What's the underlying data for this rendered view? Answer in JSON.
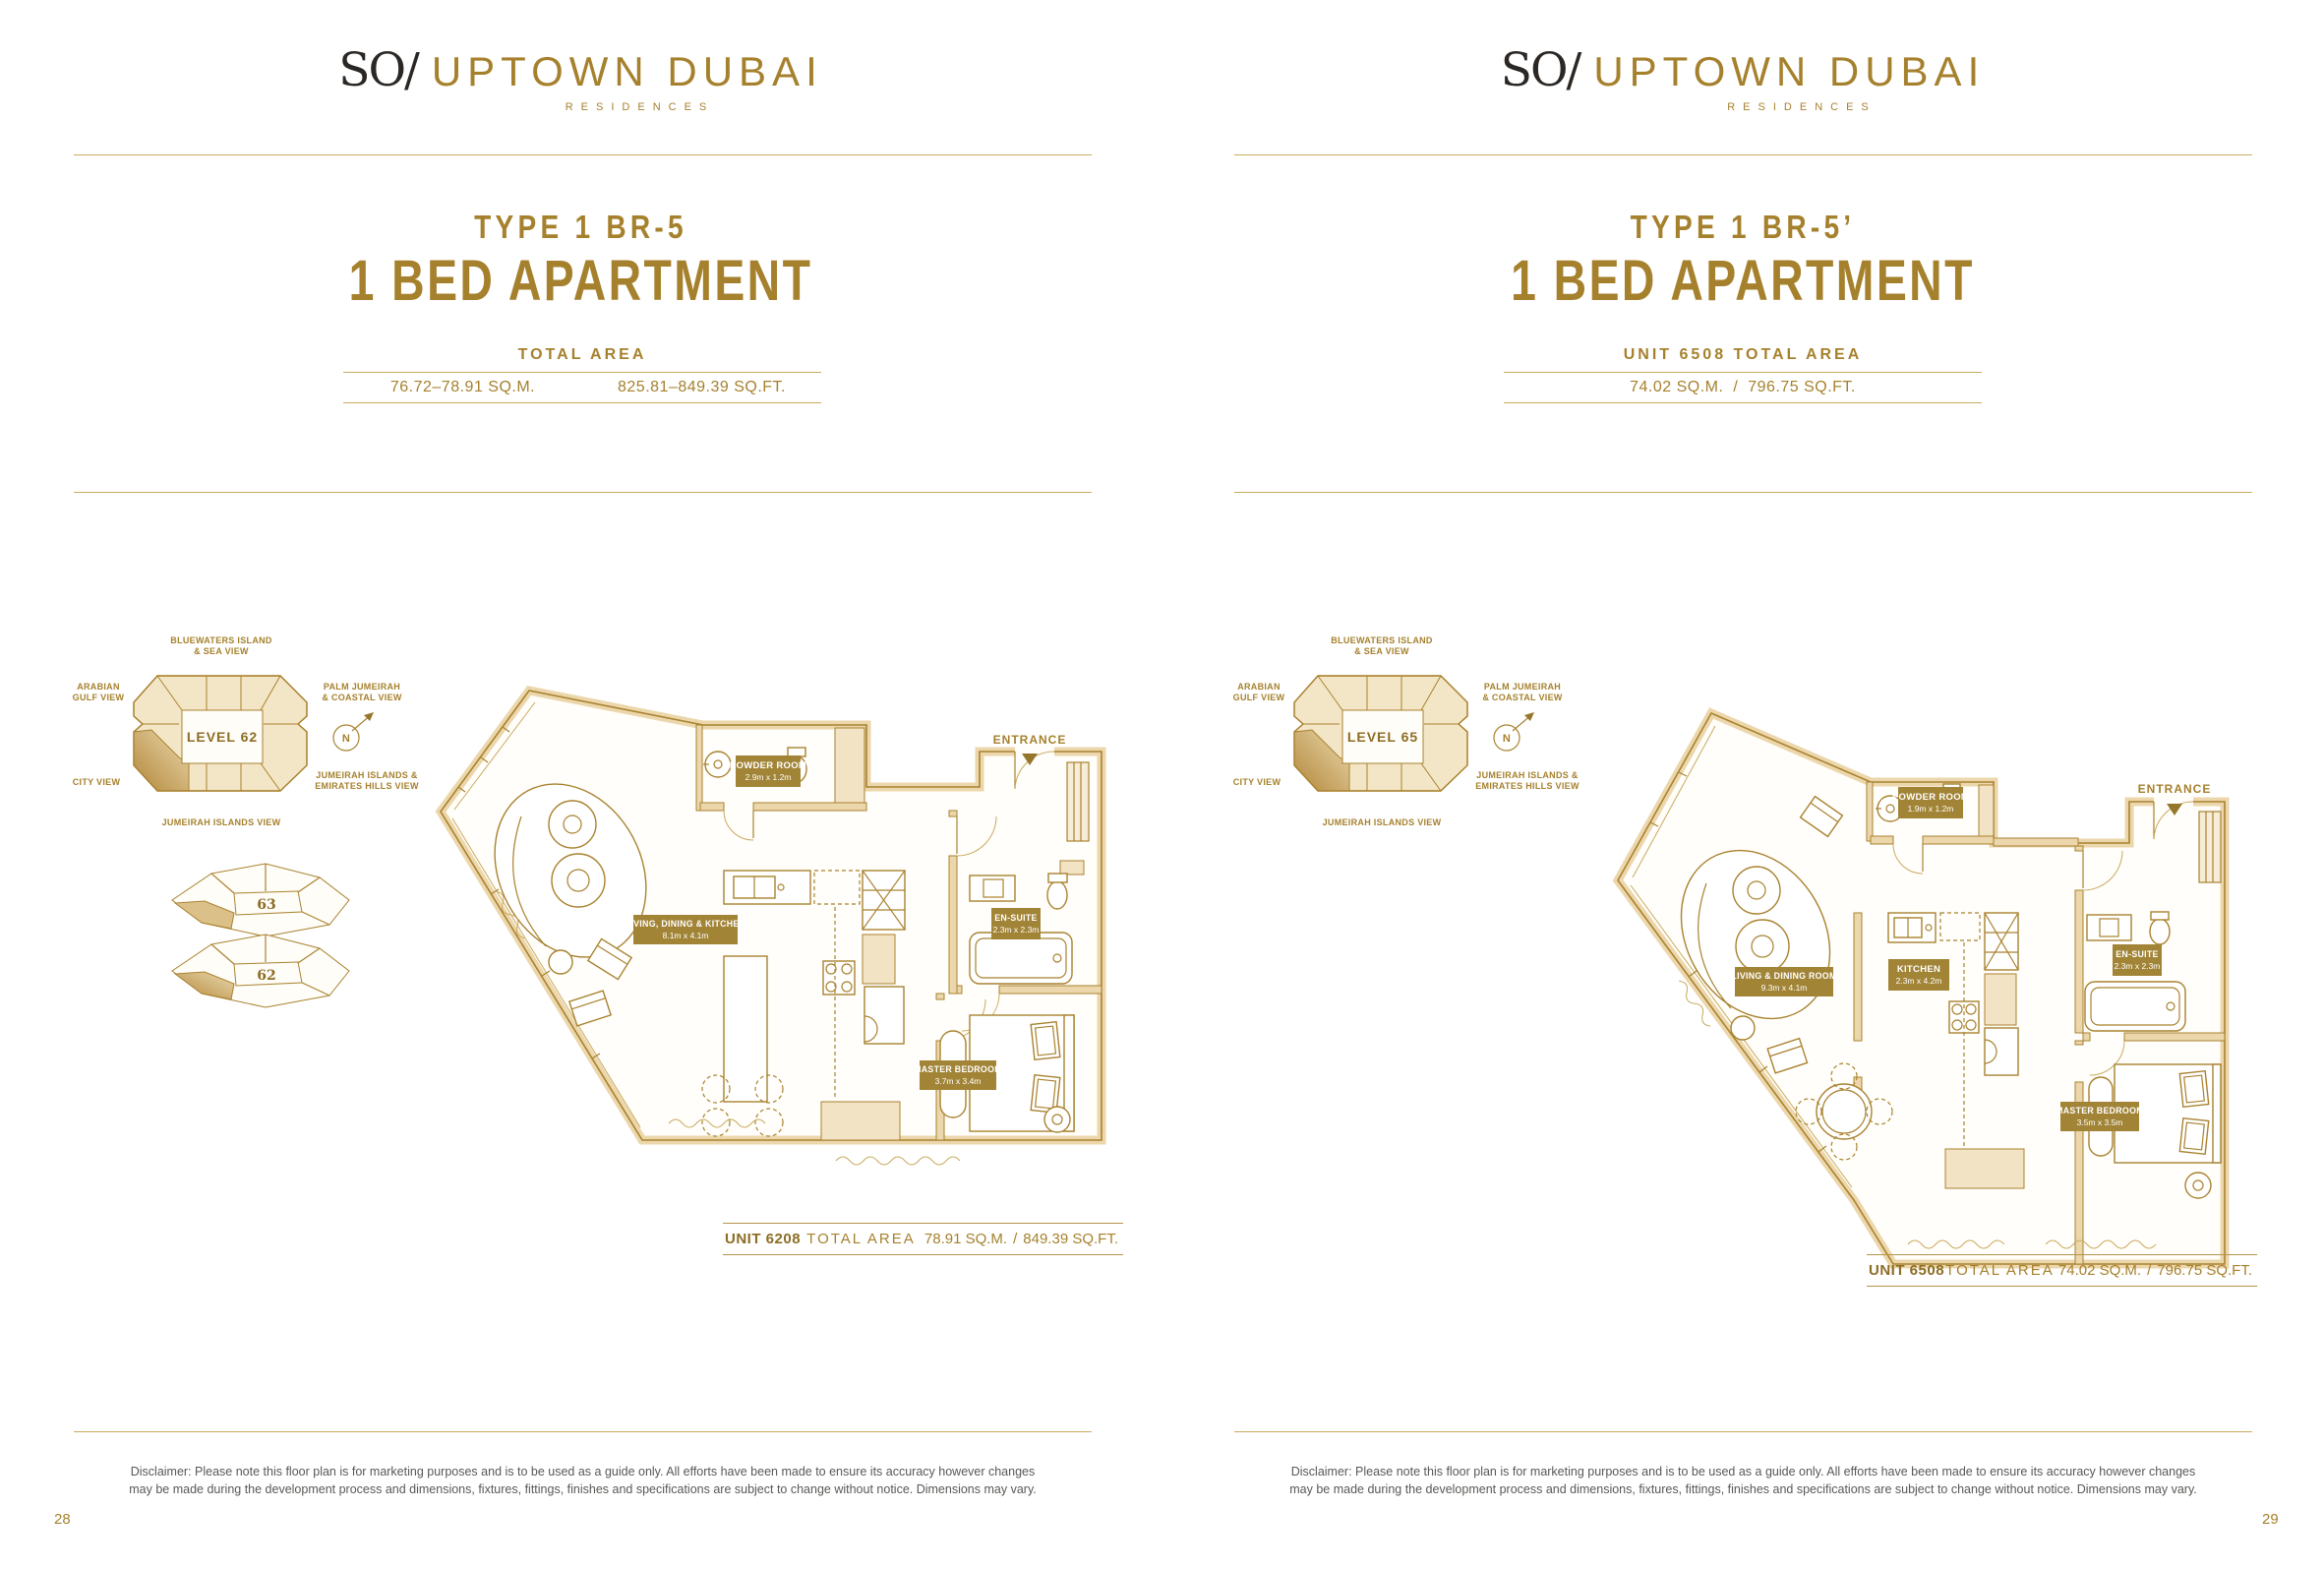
{
  "brand": {
    "mark": "SO/",
    "name": "UPTOWN DUBAI",
    "tagline": "RESIDENCES"
  },
  "shared": {
    "entrance": "ENTRANCE",
    "views": {
      "top1": "BLUEWATERS ISLAND",
      "top2": "& SEA VIEW",
      "left_upper1": "ARABIAN",
      "left_upper2": "GULF VIEW",
      "right_upper1": "PALM JUMEIRAH",
      "right_upper2": "& COASTAL VIEW",
      "left_lower": "CITY VIEW",
      "right_lower1": "JUMEIRAH ISLANDS &",
      "right_lower2": "EMIRATES HILLS VIEW",
      "bottom": "JUMEIRAH ISLANDS VIEW",
      "north": "N"
    },
    "disclaimer_l1": "Disclaimer: Please note this floor plan is for marketing purposes and is to be used as a guide only. All efforts have been made to ensure its accuracy however changes",
    "disclaimer_l2": "may be made during the development process and dimensions, fixtures, fittings, finishes and specifications are subject to change without notice. Dimensions may vary."
  },
  "left_page": {
    "type_title": "TYPE 1 BR-5",
    "main_title": "1 BED APARTMENT",
    "area_header": "TOTAL AREA",
    "area_sqm": "76.72–78.91 SQ.M.",
    "area_sqft": "825.81–849.39 SQ.FT.",
    "level": "LEVEL 62",
    "stack_top": "63",
    "stack_bottom": "62",
    "rooms": {
      "powder_name": "POWDER ROOM",
      "powder_dims": "2.9m x 1.2m",
      "living_name": "LIVING, DINING & KITCHEN",
      "living_dims": "8.1m x 4.1m",
      "ensuite_name": "EN-SUITE",
      "ensuite_dims": "2.3m x 2.3m",
      "master_name": "MASTER BEDROOM",
      "master_dims": "3.7m x 3.4m"
    },
    "unit": {
      "unit": "UNIT 6208",
      "label": "TOTAL AREA",
      "sqm": "78.91 SQ.M.",
      "sep": "/",
      "sqft": "849.39 SQ.FT."
    },
    "page_number": "28"
  },
  "right_page": {
    "type_title": "TYPE 1 BR-5’",
    "main_title": "1 BED APARTMENT",
    "area_header": "UNIT 6508 TOTAL AREA",
    "area_sqm": "74.02 SQ.M.",
    "area_sep": "/",
    "area_sqft": "796.75 SQ.FT.",
    "level": "LEVEL 65",
    "rooms": {
      "powder_name": "POWDER ROOM",
      "powder_dims": "1.9m x 1.2m",
      "living_name": "LIVING & DINING ROOM",
      "living_dims": "9.3m x 4.1m",
      "kitchen_name": "KITCHEN",
      "kitchen_dims": "2.3m x 4.2m",
      "ensuite_name": "EN-SUITE",
      "ensuite_dims": "2.3m x 2.3m",
      "master_name": "MASTER BEDROOM",
      "master_dims": "3.5m x 3.5m"
    },
    "unit": {
      "unit": "UNIT 6508",
      "label": "TOTAL AREA",
      "sqm": "74.02 SQ.M.",
      "sep": "/",
      "sqft": "796.75 SQ.FT."
    },
    "page_number": "29"
  }
}
